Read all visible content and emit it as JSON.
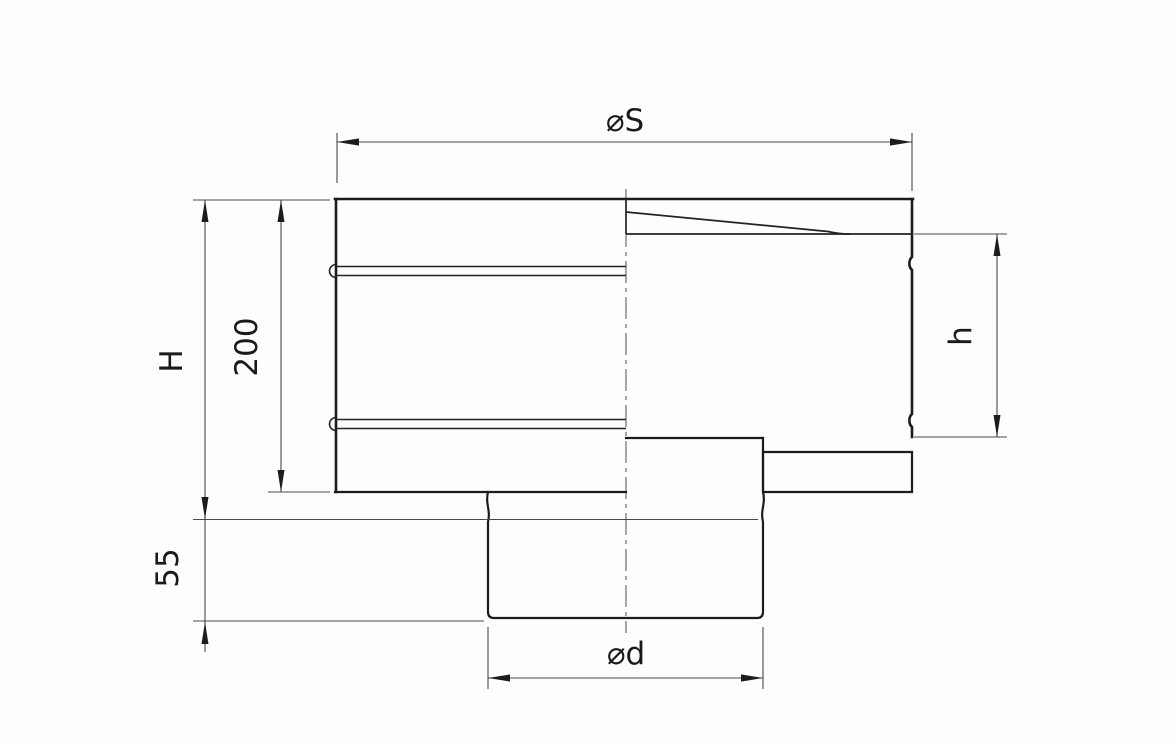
{
  "drawing": {
    "kind": "technical-dimension-drawing",
    "labels": {
      "top_diameter": "⌀S",
      "total_height": "H",
      "upper_body_height": "200",
      "shell_height": "h",
      "spigot_length": "55",
      "bottom_diameter": "⌀d"
    },
    "colors": {
      "background": "#fdfdfd",
      "object_line": "#1c1c1c",
      "dimension_line": "#4a4a4a"
    }
  }
}
